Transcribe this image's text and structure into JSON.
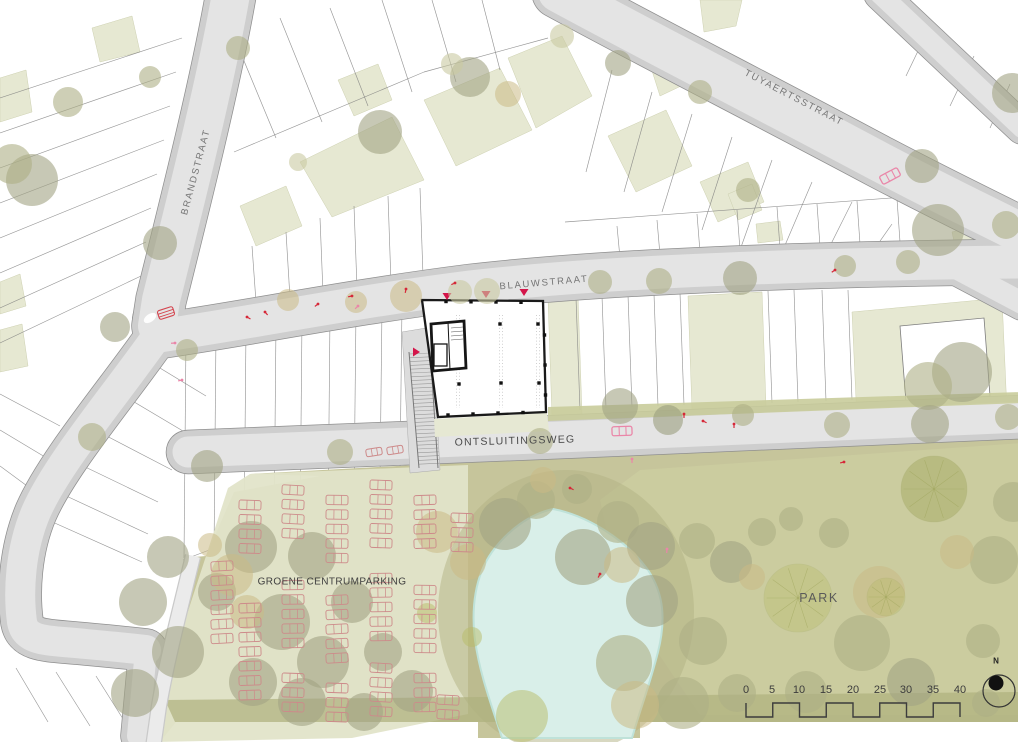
{
  "map": {
    "street_labels": {
      "brandstraat": "BRANDSTRAAT",
      "tuyaertsstraat": "TUYAERTSSTRAAT",
      "blauwstraat": "BLAUWSTRAAT",
      "ontsluitingsweg": "ONTSLUITINGSWEG"
    },
    "area_labels": {
      "parking": "GROENE CENTRUMPARKING",
      "park": "PARK"
    }
  },
  "scalebar": {
    "ticks": [
      "0",
      "5",
      "10",
      "15",
      "20",
      "25",
      "30",
      "35",
      "40"
    ],
    "north_label": "N"
  },
  "colors": {
    "road_fill": "#e4e4e4",
    "road_casing": "#cecece",
    "road_rim": "#8f8f8f",
    "path_fill": "#ebebeb",
    "parcel_line": "#7d7d7d",
    "parcel_white": "#ffffff",
    "courtyard_green": "#e6e8d2",
    "verge_green": "#c9cc9b",
    "park_base": "#c6c59b",
    "park_light": "#cbcda0",
    "park_dark": "#aeb17d",
    "parking_lot": "#e2e4c9",
    "wetland": "#b2b183",
    "pond": "#d9efe9",
    "pond_edge": "#bfe2d9",
    "tree_palette": [
      "#a2a384",
      "#aeaf85",
      "#cbb985",
      "#b8bc68",
      "#c9caa2",
      "#9b9e7f"
    ],
    "building_outline": "#1a1a1a",
    "accent_red": "#d4154a",
    "accent_pink": "#ea86a8",
    "car_red": "#cd8a8a",
    "label_street": "#757575",
    "label_area": "#3f3f3f",
    "label_park": "#5a5a5a",
    "scalebar_ink": "#3c3c3c"
  }
}
